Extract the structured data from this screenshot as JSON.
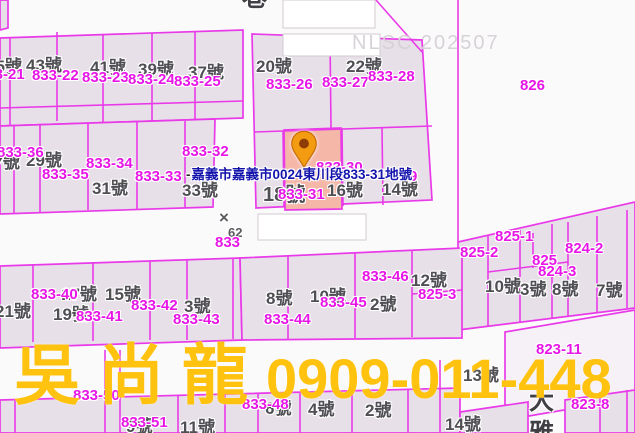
{
  "map": {
    "nlsc_watermark": "NLSC 202507",
    "tooltip": {
      "prefix": "-",
      "text": "嘉義市嘉義市0024東川段833-31地號"
    },
    "marker": {
      "icon": "location-pin",
      "parcel": "833-31"
    },
    "watermark": {
      "name": "吳尚龍",
      "phone": "0909-011-448",
      "color": "#ffc20e"
    },
    "colors": {
      "boundary_line": "#e93ae9",
      "parcel_label": "#e716e7",
      "street_label": "#4f4e53",
      "tooltip_text": "#1414ad",
      "highlight_parcel_fill": "#f4b7a8",
      "pin_fill": "#f39c12",
      "nlsc_text": "#d7d2d7"
    },
    "labels": [
      {
        "text": "45號",
        "x": -14,
        "y": 58,
        "type": "street"
      },
      {
        "text": "43號",
        "x": 26,
        "y": 57,
        "type": "street"
      },
      {
        "text": "41號",
        "x": 90,
        "y": 59,
        "type": "street"
      },
      {
        "text": "39號",
        "x": 138,
        "y": 61,
        "type": "street"
      },
      {
        "text": "37號",
        "x": 188,
        "y": 64,
        "type": "street"
      },
      {
        "text": "20號",
        "x": 256,
        "y": 58,
        "type": "street"
      },
      {
        "text": "22號",
        "x": 346,
        "y": 58,
        "type": "street"
      },
      {
        "text": "27號",
        "x": -16,
        "y": 154,
        "type": "street"
      },
      {
        "text": "29號",
        "x": 26,
        "y": 152,
        "type": "street"
      },
      {
        "text": "31號",
        "x": 92,
        "y": 180,
        "type": "street"
      },
      {
        "text": "33號",
        "x": 182,
        "y": 182,
        "type": "street"
      },
      {
        "text": "18號",
        "x": 263,
        "y": 185,
        "type": "street",
        "size": 20
      },
      {
        "text": "16號",
        "x": 327,
        "y": 182,
        "type": "street"
      },
      {
        "text": "14號",
        "x": 382,
        "y": 181,
        "type": "street"
      },
      {
        "text": "12號",
        "x": 411,
        "y": 272,
        "type": "street"
      },
      {
        "text": "10號",
        "x": 485,
        "y": 278,
        "type": "street"
      },
      {
        "text": "3號",
        "x": 520,
        "y": 281,
        "type": "street"
      },
      {
        "text": "8號",
        "x": 552,
        "y": 281,
        "type": "street"
      },
      {
        "text": "7號",
        "x": 596,
        "y": 282,
        "type": "street"
      },
      {
        "text": "17號",
        "x": 61,
        "y": 286,
        "type": "street"
      },
      {
        "text": "15號",
        "x": 105,
        "y": 286,
        "type": "street"
      },
      {
        "text": "21號",
        "x": -5,
        "y": 303,
        "type": "street"
      },
      {
        "text": "19號",
        "x": 53,
        "y": 306,
        "type": "street"
      },
      {
        "text": "3號",
        "x": 184,
        "y": 298,
        "type": "street"
      },
      {
        "text": "8號",
        "x": 266,
        "y": 290,
        "type": "street"
      },
      {
        "text": "10號",
        "x": 310,
        "y": 288,
        "type": "street"
      },
      {
        "text": "2號",
        "x": 370,
        "y": 296,
        "type": "street"
      },
      {
        "text": "13號",
        "x": 463,
        "y": 367,
        "type": "street"
      },
      {
        "text": "14號",
        "x": 445,
        "y": 416,
        "type": "street"
      },
      {
        "text": "9號",
        "x": 126,
        "y": 418,
        "type": "street"
      },
      {
        "text": "11號",
        "x": 180,
        "y": 419,
        "type": "street"
      },
      {
        "text": "6號",
        "x": 265,
        "y": 400,
        "type": "street"
      },
      {
        "text": "4號",
        "x": 308,
        "y": 401,
        "type": "street"
      },
      {
        "text": "2號",
        "x": 365,
        "y": 402,
        "type": "street"
      },
      {
        "text": "×",
        "x": 219,
        "y": 209,
        "type": "survey",
        "size": 17
      },
      {
        "text": "62",
        "x": 228,
        "y": 226,
        "type": "survey",
        "size": 13
      },
      {
        "text": "833-21",
        "x": -22,
        "y": 67,
        "type": "parcel"
      },
      {
        "text": "833-22",
        "x": 32,
        "y": 68,
        "type": "parcel"
      },
      {
        "text": "833-23",
        "x": 82,
        "y": 70,
        "type": "parcel"
      },
      {
        "text": "833-24",
        "x": 128,
        "y": 72,
        "type": "parcel"
      },
      {
        "text": "833-25",
        "x": 174,
        "y": 74,
        "type": "parcel"
      },
      {
        "text": "833-26",
        "x": 266,
        "y": 77,
        "type": "parcel"
      },
      {
        "text": "833-27",
        "x": 322,
        "y": 75,
        "type": "parcel"
      },
      {
        "text": "833-28",
        "x": 368,
        "y": 69,
        "type": "parcel"
      },
      {
        "text": "826",
        "x": 520,
        "y": 78,
        "type": "parcel"
      },
      {
        "text": "833-36",
        "x": -3,
        "y": 145,
        "type": "parcel"
      },
      {
        "text": "833-32",
        "x": 182,
        "y": 144,
        "type": "parcel"
      },
      {
        "text": "833-34",
        "x": 86,
        "y": 156,
        "type": "parcel"
      },
      {
        "text": "833-35",
        "x": 42,
        "y": 167,
        "type": "parcel"
      },
      {
        "text": "833-33",
        "x": 135,
        "y": 169,
        "type": "parcel"
      },
      {
        "text": "833-31",
        "x": 278,
        "y": 187,
        "type": "parcel"
      },
      {
        "text": "833-30",
        "x": 316,
        "y": 160,
        "type": "parcel"
      },
      {
        "text": "9",
        "x": 409,
        "y": 169,
        "type": "parcel"
      },
      {
        "text": "833",
        "x": 215,
        "y": 235,
        "type": "parcel"
      },
      {
        "text": "825-1",
        "x": 495,
        "y": 229,
        "type": "parcel"
      },
      {
        "text": "825-2",
        "x": 460,
        "y": 245,
        "type": "parcel"
      },
      {
        "text": "824-2",
        "x": 565,
        "y": 241,
        "type": "parcel"
      },
      {
        "text": "825",
        "x": 532,
        "y": 253,
        "type": "parcel"
      },
      {
        "text": "824-3",
        "x": 538,
        "y": 264,
        "type": "parcel"
      },
      {
        "text": "825-3",
        "x": 418,
        "y": 287,
        "type": "parcel"
      },
      {
        "text": "833-46",
        "x": 362,
        "y": 269,
        "type": "parcel"
      },
      {
        "text": "833-45",
        "x": 320,
        "y": 295,
        "type": "parcel"
      },
      {
        "text": "833-44",
        "x": 264,
        "y": 312,
        "type": "parcel"
      },
      {
        "text": "833-40",
        "x": 31,
        "y": 287,
        "type": "parcel"
      },
      {
        "text": "833-42",
        "x": 131,
        "y": 298,
        "type": "parcel"
      },
      {
        "text": "833-41",
        "x": 76,
        "y": 309,
        "type": "parcel"
      },
      {
        "text": "833-43",
        "x": 173,
        "y": 312,
        "type": "parcel"
      },
      {
        "text": "823-11",
        "x": 536,
        "y": 342,
        "type": "parcel"
      },
      {
        "text": "823-8",
        "x": 571,
        "y": 397,
        "type": "parcel"
      },
      {
        "text": "833-50",
        "x": 73,
        "y": 388,
        "type": "parcel"
      },
      {
        "text": "833-51",
        "x": 121,
        "y": 415,
        "type": "parcel"
      },
      {
        "text": "833-48",
        "x": 242,
        "y": 397,
        "type": "parcel"
      },
      {
        "text": "巷",
        "x": 242,
        "y": -14,
        "type": "road"
      },
      {
        "text": "大",
        "x": 529,
        "y": 389,
        "type": "road"
      },
      {
        "text": "雅",
        "x": 529,
        "y": 421,
        "type": "road"
      }
    ]
  }
}
